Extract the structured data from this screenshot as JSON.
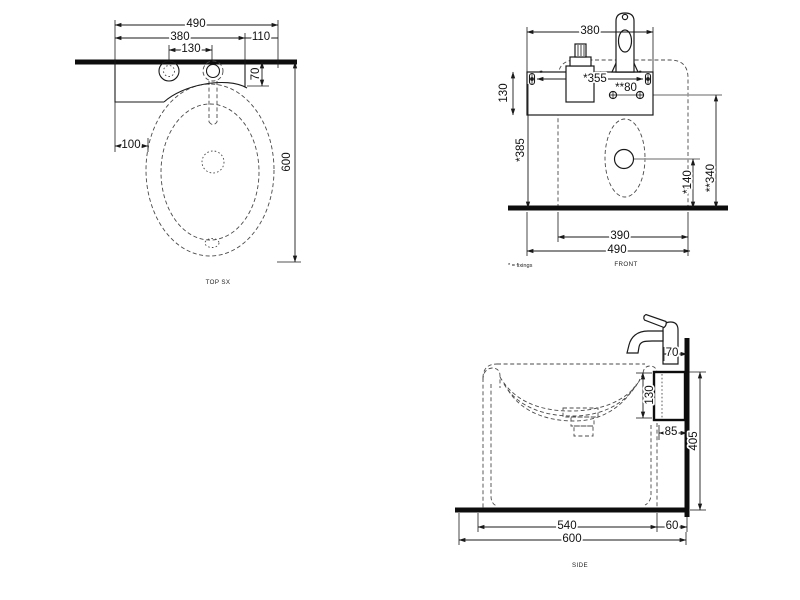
{
  "drawing": {
    "type": "technical-dimension-drawing",
    "subject": "wall-hung basin with shelf and mixer tap",
    "colors": {
      "line": "#1a1a1a",
      "dashed": "#4a4a4a",
      "reference": "#9a9a9a",
      "background": "#ffffff"
    },
    "views": {
      "top": {
        "label": "TOP SX",
        "dim_width_overall": "490",
        "dim_shelf_width": "380",
        "dim_hole_spacing": "130",
        "dim_right_offset": "110",
        "dim_wall_offset": "70",
        "dim_left_offset": "100",
        "dim_depth_overall": "600"
      },
      "front": {
        "label": "FRONT",
        "note": "* = fixings",
        "fixing_mark": "*",
        "dim_tap_width": "380",
        "dim_fixing_spacing": "*355",
        "dim_wall_fixing_spacing": "**80",
        "dim_shelf_height": "130",
        "dim_fixing_height": "*385",
        "dim_drain_height": "*140",
        "dim_wall_fixing_height": "**340",
        "dim_body_width": "390",
        "dim_width_overall": "490"
      },
      "side": {
        "label": "SIDE",
        "dim_tap_offset": "70",
        "dim_shelf_height": "130",
        "dim_shelf_depth": "85",
        "dim_shelf_top_height": "405",
        "dim_body_depth": "540",
        "dim_wall_gap": "60",
        "dim_depth_overall": "600"
      }
    }
  }
}
